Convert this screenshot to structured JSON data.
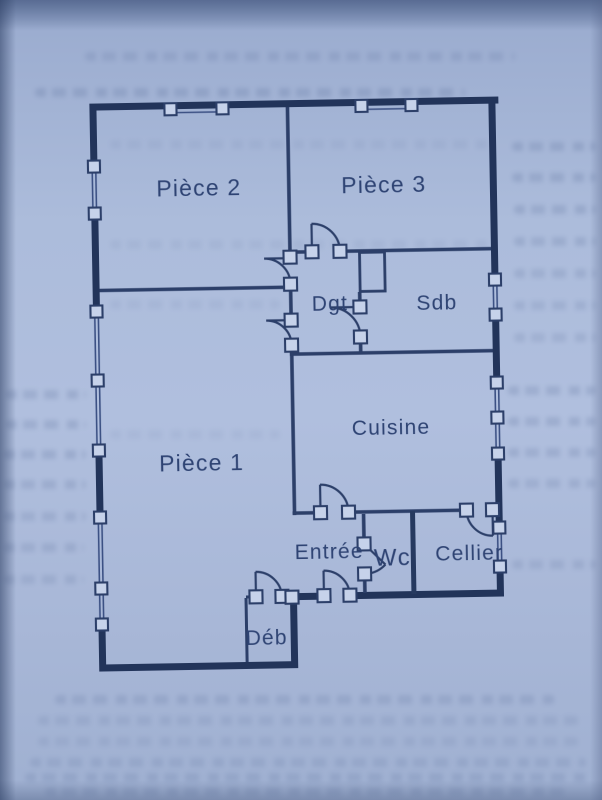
{
  "page": {
    "description": "Scanned book page with apartment floor plan, bluish paper with bleed-through text"
  },
  "plan": {
    "rooms": {
      "piece2": {
        "label": "Pièce 2"
      },
      "piece3": {
        "label": "Pièce 3"
      },
      "piece1": {
        "label": "Pièce 1"
      },
      "dgt": {
        "label": "Dgt"
      },
      "sdb": {
        "label": "Sdb"
      },
      "cuisine": {
        "label": "Cuisine"
      },
      "entree": {
        "label": "Entrée"
      },
      "wc": {
        "label": "Wc"
      },
      "cellier": {
        "label": "Cellier"
      },
      "deb": {
        "label": "Déb"
      }
    },
    "colors": {
      "ink": "#2c3f69",
      "outer_wall": "#22345a",
      "paper": "#acbcdb",
      "post_fill": "#c6d2ea"
    }
  }
}
